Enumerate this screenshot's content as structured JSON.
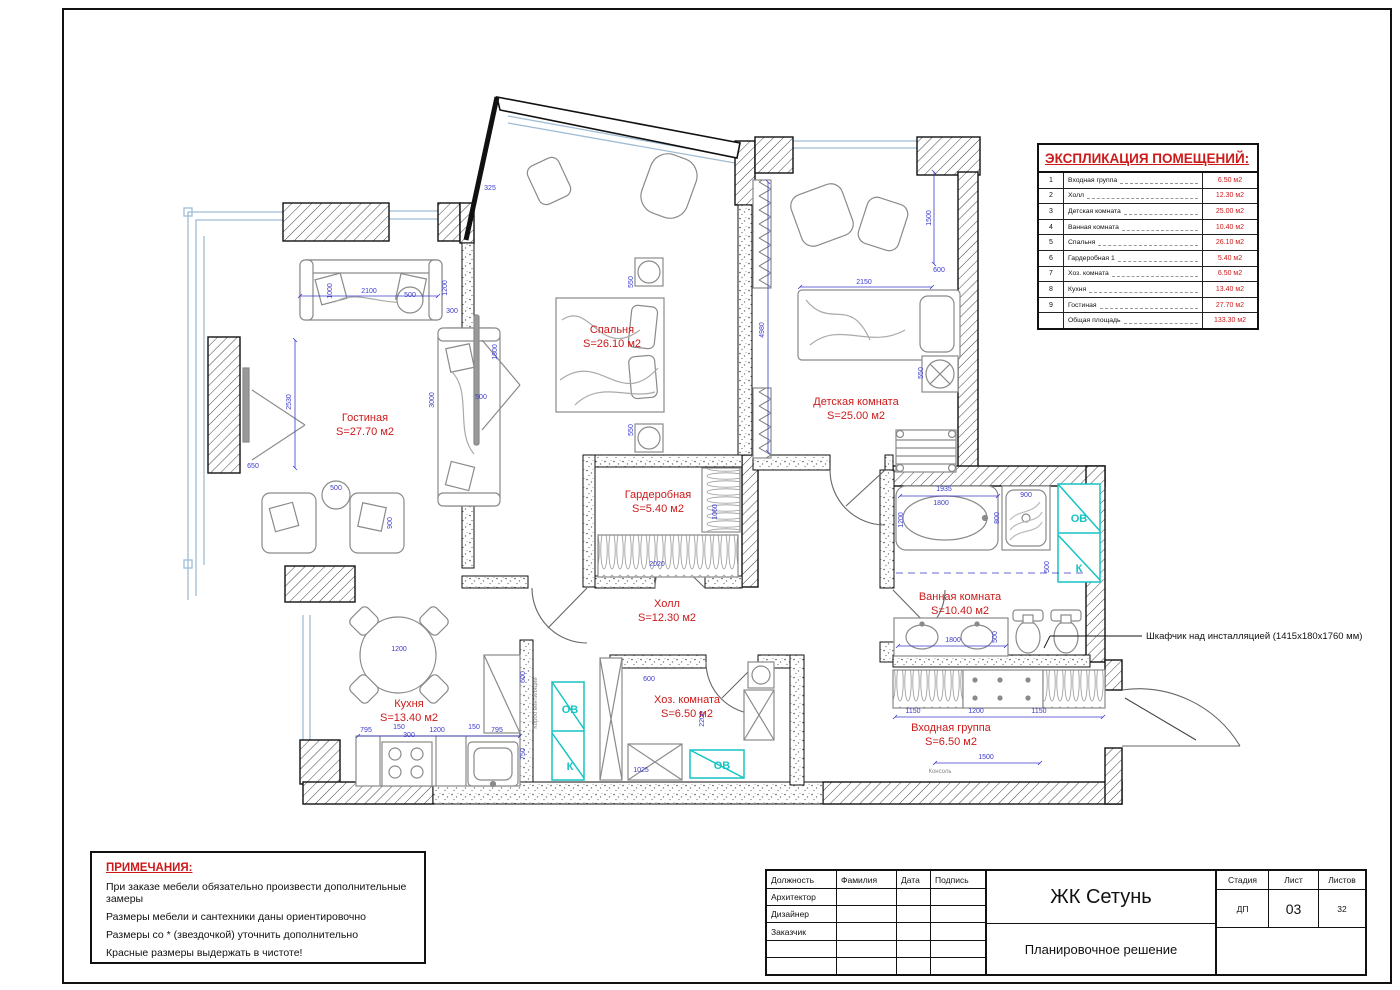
{
  "colors": {
    "label_red": "#cc1a1a",
    "dim_blue": "#3a3acc",
    "vent_cyan": "#17c3c3",
    "wall_black": "#111111",
    "window_blue": "#9fbcd4"
  },
  "explication": {
    "title": "ЭКСПЛИКАЦИЯ ПОМЕЩЕНИЙ:",
    "rows": [
      {
        "num": "1",
        "name": "Входная группа",
        "area": "6.50 м2"
      },
      {
        "num": "2",
        "name": "Холл",
        "area": "12.30 м2"
      },
      {
        "num": "3",
        "name": "Детская комната",
        "area": "25.00 м2"
      },
      {
        "num": "4",
        "name": "Ванная комната",
        "area": "10.40 м2"
      },
      {
        "num": "5",
        "name": "Спальня",
        "area": "26.10 м2"
      },
      {
        "num": "6",
        "name": "Гардеробная 1",
        "area": "5.40 м2"
      },
      {
        "num": "7",
        "name": "Хоз. комната",
        "area": "6.50 м2"
      },
      {
        "num": "8",
        "name": "Кухня",
        "area": "13.40 м2"
      },
      {
        "num": "9",
        "name": "Гостиная",
        "area": "27.70 м2"
      },
      {
        "num": "",
        "name": "Общая площадь",
        "area": "133.30 м2"
      }
    ]
  },
  "notes": {
    "title": "ПРИМЕЧАНИЯ:",
    "lines": [
      "При заказе мебели обязательно произвести дополнительные замеры",
      "Размеры мебели и сантехники даны ориентировочно",
      "Размеры со * (звездочкой) уточнить дополнительно",
      "Красные размеры выдержать в чистоте!"
    ]
  },
  "title_block": {
    "col_headers": [
      "Должность",
      "Фамилия",
      "Дата",
      "Подпись"
    ],
    "roles": [
      "Архитектор",
      "Дизайнер",
      "Заказчик",
      "",
      ""
    ],
    "project": "ЖК Сетунь",
    "drawing": "Планировочное решение",
    "stage_label": "Стадия",
    "stage": "ДП",
    "sheet_label": "Лист",
    "sheet": "03",
    "sheets_label": "Листов",
    "sheets": "32"
  },
  "rooms": [
    {
      "name": "Гостиная",
      "area": "S=27.70 м2",
      "x": 365,
      "y": 421
    },
    {
      "name": "Спальня",
      "area": "S=26.10 м2",
      "x": 612,
      "y": 333
    },
    {
      "name": "Детская комната",
      "area": "S=25.00 м2",
      "x": 856,
      "y": 405
    },
    {
      "name": "Гардеробная",
      "area": "S=5.40 м2",
      "x": 658,
      "y": 498
    },
    {
      "name": "Холл",
      "area": "S=12.30 м2",
      "x": 667,
      "y": 607
    },
    {
      "name": "Кухня",
      "area": "S=13.40 м2",
      "x": 409,
      "y": 707
    },
    {
      "name": "Хоз. комната",
      "area": "S=6.50 м2",
      "x": 687,
      "y": 703
    },
    {
      "name": "Ванная комната",
      "area": "S=10.40 м2",
      "x": 960,
      "y": 600
    },
    {
      "name": "Входная группа",
      "area": "S=6.50 м2",
      "x": 951,
      "y": 731
    }
  ],
  "annotation": {
    "text": "Шкафчик над инсталляцией (1415x180x1760 мм)"
  },
  "vents": [
    {
      "label": "ОВ",
      "x": 570,
      "y": 713
    },
    {
      "label": "К",
      "x": 570,
      "y": 770
    },
    {
      "label": "ОВ",
      "x": 722,
      "y": 769
    },
    {
      "label": "ОВ",
      "x": 1079,
      "y": 522
    },
    {
      "label": "К",
      "x": 1079,
      "y": 572
    }
  ],
  "small_labels": [
    {
      "t": "Короб вентиляции",
      "x": 537,
      "y": 703,
      "r": -90
    },
    {
      "t": "Консоль",
      "x": 940,
      "y": 773,
      "r": 0
    }
  ],
  "dimensions": [
    {
      "t": "2100",
      "x": 369,
      "y": 293,
      "r": 0
    },
    {
      "t": "1000",
      "x": 332,
      "y": 291,
      "r": -90
    },
    {
      "t": "500",
      "x": 410,
      "y": 297,
      "r": 0
    },
    {
      "t": "1200",
      "x": 447,
      "y": 288,
      "r": -90
    },
    {
      "t": "300",
      "x": 452,
      "y": 313,
      "r": 0
    },
    {
      "t": "2530",
      "x": 291,
      "y": 402,
      "r": -90
    },
    {
      "t": "650",
      "x": 253,
      "y": 468,
      "r": 0
    },
    {
      "t": "3000",
      "x": 434,
      "y": 400,
      "r": -90
    },
    {
      "t": "500",
      "x": 336,
      "y": 490,
      "r": 0
    },
    {
      "t": "900",
      "x": 392,
      "y": 523,
      "r": -90
    },
    {
      "t": "325",
      "x": 490,
      "y": 190,
      "r": 0
    },
    {
      "t": "1800",
      "x": 497,
      "y": 352,
      "r": -90
    },
    {
      "t": "500",
      "x": 481,
      "y": 399,
      "r": 0
    },
    {
      "t": "550",
      "x": 633,
      "y": 282,
      "r": -90
    },
    {
      "t": "550",
      "x": 633,
      "y": 430,
      "r": -90
    },
    {
      "t": "4980",
      "x": 764,
      "y": 330,
      "r": -90
    },
    {
      "t": "1500",
      "x": 931,
      "y": 218,
      "r": -90
    },
    {
      "t": "600",
      "x": 939,
      "y": 272,
      "r": 0
    },
    {
      "t": "2150",
      "x": 864,
      "y": 284,
      "r": 0
    },
    {
      "t": "550",
      "x": 923,
      "y": 373,
      "r": -90
    },
    {
      "t": "2020",
      "x": 657,
      "y": 566,
      "r": 0
    },
    {
      "t": "1060",
      "x": 717,
      "y": 512,
      "r": -90
    },
    {
      "t": "1935",
      "x": 944,
      "y": 491,
      "r": 0
    },
    {
      "t": "1800",
      "x": 941,
      "y": 505,
      "r": 0
    },
    {
      "t": "1200",
      "x": 903,
      "y": 520,
      "r": -90
    },
    {
      "t": "800",
      "x": 999,
      "y": 518,
      "r": -90
    },
    {
      "t": "900",
      "x": 1026,
      "y": 497,
      "r": 0
    },
    {
      "t": "500",
      "x": 1049,
      "y": 567,
      "r": -90
    },
    {
      "t": "1800",
      "x": 953,
      "y": 642,
      "r": 0
    },
    {
      "t": "500",
      "x": 997,
      "y": 637,
      "r": -90
    },
    {
      "t": "1150",
      "x": 913,
      "y": 713,
      "r": 0
    },
    {
      "t": "1200",
      "x": 976,
      "y": 713,
      "r": 0
    },
    {
      "t": "1150",
      "x": 1039,
      "y": 713,
      "r": 0
    },
    {
      "t": "1500",
      "x": 986,
      "y": 759,
      "r": 0
    },
    {
      "t": "600",
      "x": 649,
      "y": 681,
      "r": 0
    },
    {
      "t": "2200",
      "x": 704,
      "y": 719,
      "r": -90
    },
    {
      "t": "1025",
      "x": 641,
      "y": 772,
      "r": 0
    },
    {
      "t": "1200",
      "x": 399,
      "y": 651,
      "r": 0
    },
    {
      "t": "795",
      "x": 366,
      "y": 732,
      "r": 0
    },
    {
      "t": "150",
      "x": 399,
      "y": 729,
      "r": 0
    },
    {
      "t": "300",
      "x": 409,
      "y": 737,
      "r": 0
    },
    {
      "t": "1200",
      "x": 437,
      "y": 732,
      "r": 0
    },
    {
      "t": "150",
      "x": 474,
      "y": 729,
      "r": 0
    },
    {
      "t": "795",
      "x": 497,
      "y": 732,
      "r": 0
    },
    {
      "t": "750",
      "x": 525,
      "y": 754,
      "r": -90
    },
    {
      "t": "600",
      "x": 525,
      "y": 677,
      "r": -90
    }
  ]
}
